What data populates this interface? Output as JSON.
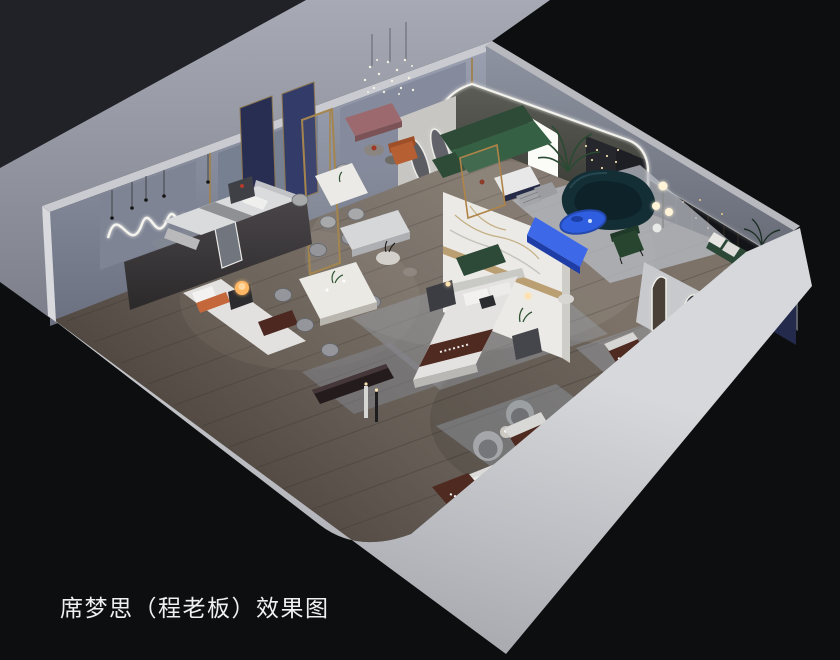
{
  "caption": {
    "text": "席梦思（程老板）效果图"
  },
  "render": {
    "type": "interior-3d-cutaway-rendering",
    "objects": [
      "outer-display-walls",
      "gray-backdrop-wall",
      "white-platform-base",
      "wood-plank-floor",
      "led-arch-display-cove",
      "backlit-light-panel",
      "potted-palm",
      "hanging-dot-curtain",
      "green-corner-sofa",
      "dark-teal-curved-sofa",
      "blue-oval-coffee-table",
      "blue-media-console",
      "green-velvet-armchair",
      "striped-gray-poufs",
      "mauve-display-bench",
      "burnt-orange-armchair",
      "marble-feature-partition",
      "oval-mirror-display-panel",
      "navy-fabric-partition-panels",
      "black-accent-wall-with-string-lights",
      "navy-corner-panel",
      "green-bench-with-pillows",
      "arched-floor-mirrors",
      "leaning-dress-mirror",
      "neon-squiggle-wall-light",
      "dot-chandelier",
      "double-bed-with-branded-runner",
      "platform-bed-gray",
      "bed-with-orange-bolster",
      "branded-mattress-displays",
      "nightstands",
      "glowing-orb-lamp",
      "dining-table-six-chairs",
      "dining-table-four-chairs",
      "barrel-swivel-chairs",
      "floor-lamps",
      "area-rugs",
      "display-benches",
      "pedestal-side-tables"
    ]
  },
  "colors": {
    "background": "#0d0e10",
    "backdrop_dark": "#212227",
    "backdrop_gray": "#a7aab5",
    "wall_interior": "#8e93a2",
    "platform_white": "#cdcfd4",
    "floor_wood": "#6e655d",
    "accent_blue": "#2f5fe0",
    "console_blue": "#3d68e8",
    "sofa_green": "#2d4b37",
    "sofa_teal": "#142e36",
    "mattress_brown": "#4e2a21",
    "led_white": "#f3f2ec",
    "brass_trim": "#a5854e",
    "caption_text": "#f0f0f0"
  }
}
